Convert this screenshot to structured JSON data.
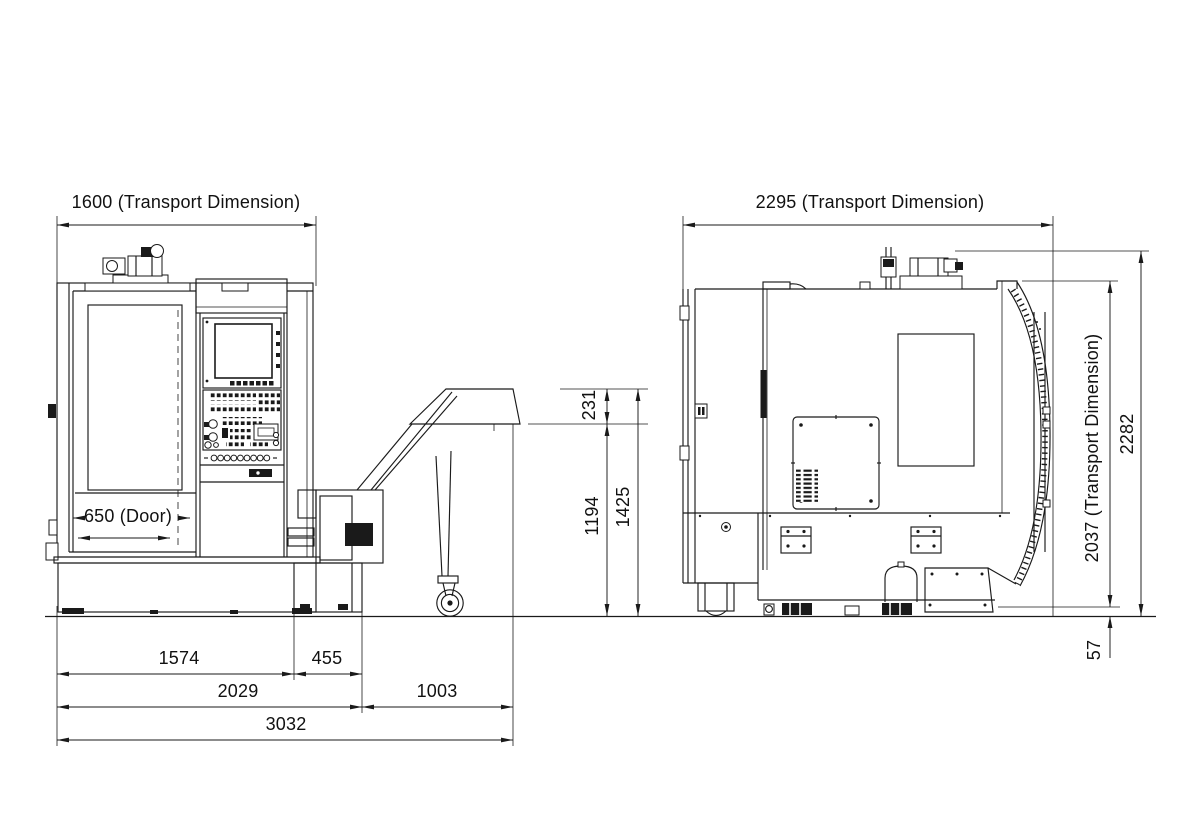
{
  "colors": {
    "line": "#1a1a1a",
    "background": "#ffffff"
  },
  "views": {
    "front": {
      "label_transport_width": "1600 (Transport Dimension)",
      "label_door": "650 (Door)",
      "label_discharge_drop": "231",
      "label_conveyor_underside_height": "1194",
      "label_conveyor_overall_height": "1425",
      "label_machine_base_width": "1574",
      "label_conveyor_offset": "455",
      "label_conveyor_overhang": "1003",
      "label_width_with_tank": "2029",
      "label_overall_width": "3032"
    },
    "side": {
      "label_transport_depth": "2295 (Transport Dimension)",
      "label_transport_height": "2037 (Transport Dimension)",
      "label_overall_height": "2282",
      "label_skid_height": "57"
    }
  }
}
